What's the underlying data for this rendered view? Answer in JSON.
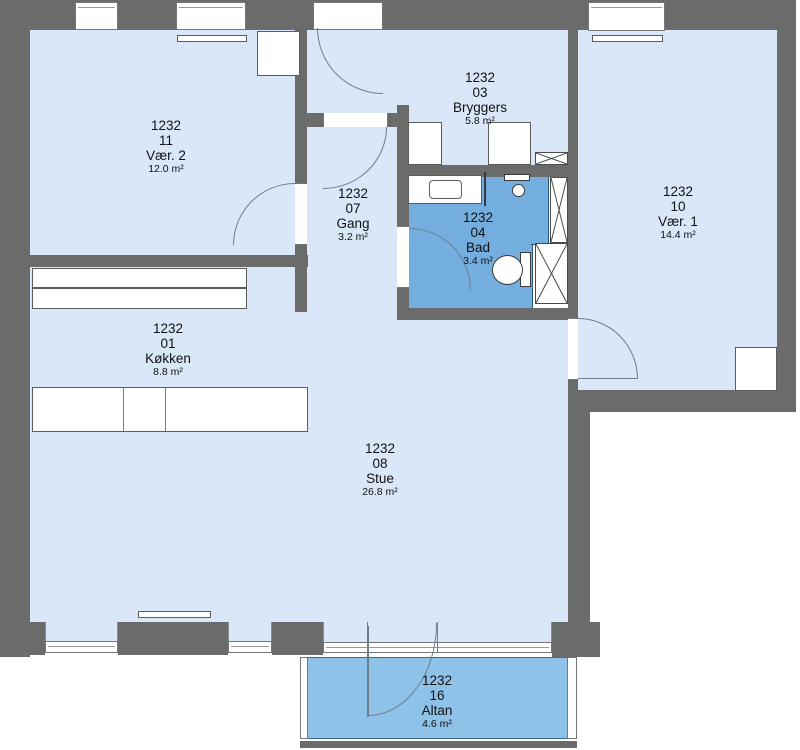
{
  "plan": {
    "unit_code": "1232",
    "rooms": [
      {
        "code": "1232",
        "room_no": "11",
        "name": "Vær. 2",
        "area": "12.0 m²"
      },
      {
        "code": "1232",
        "room_no": "03",
        "name": "Bryggers",
        "area": "5.8 m²"
      },
      {
        "code": "1232",
        "room_no": "07",
        "name": "Gang",
        "area": "3.2 m²"
      },
      {
        "code": "1232",
        "room_no": "04",
        "name": "Bad",
        "area": "3.4 m²"
      },
      {
        "code": "1232",
        "room_no": "10",
        "name": "Vær. 1",
        "area": "14.4 m²"
      },
      {
        "code": "1232",
        "room_no": "01",
        "name": "Køkken",
        "area": "8.8 m²"
      },
      {
        "code": "1232",
        "room_no": "08",
        "name": "Stue",
        "area": "26.8 m²"
      },
      {
        "code": "1232",
        "room_no": "16",
        "name": "Altan",
        "area": "4.6 m²"
      }
    ],
    "colors": {
      "room_fill": "#d9e7f9",
      "bathroom_fill": "#74aede",
      "balcony_fill": "#8fc2e8",
      "wall": "#6b6b6b",
      "background": "#ffffff",
      "door_arc": "#6d7f8f"
    }
  }
}
